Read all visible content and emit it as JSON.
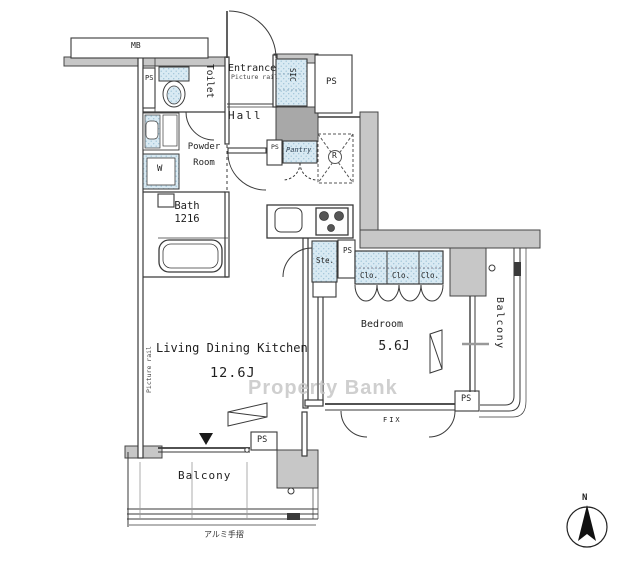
{
  "watermark": "Property Bank",
  "compass": {
    "north": "N"
  },
  "caption_handrail": "アルミ手摺",
  "rooms": {
    "entrance": {
      "label": "Entrance",
      "note": "Picture rail"
    },
    "hall": {
      "label": "Hall"
    },
    "toilet": {
      "label": "Toilet"
    },
    "powder_room": {
      "label": "Powder\nRoom"
    },
    "bath": {
      "label": "Bath\n1216"
    },
    "ldk": {
      "label": "Living Dining Kitchen",
      "size": "12.6J",
      "note": "Picture rail"
    },
    "bedroom": {
      "label": "Bedroom",
      "size": "5.6J"
    },
    "balcony_bottom": {
      "label": "Balcony"
    },
    "balcony_right": {
      "label": "Balcony"
    }
  },
  "labels": {
    "mb": "MB",
    "ps": "PS",
    "sic": "SIC",
    "washer": "W",
    "fridge": "R",
    "storage": "Ste.",
    "closet": "Clo.",
    "pantry": "Pantry",
    "fix": "FIX"
  }
}
